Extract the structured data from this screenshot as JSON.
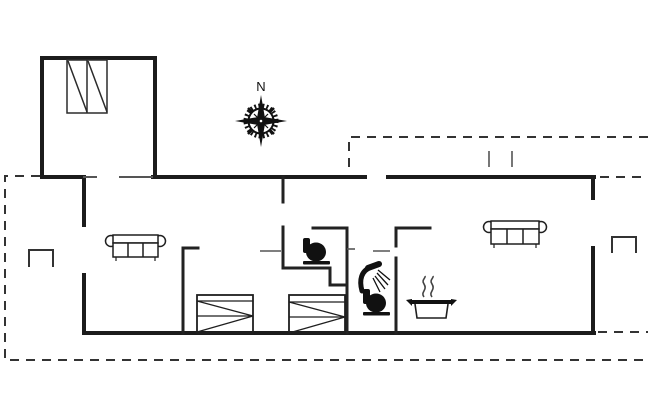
{
  "canvas": {
    "width": 650,
    "height": 420,
    "background": "#ffffff"
  },
  "colors": {
    "exterior_wall": "#1c1c1c",
    "interior_wall": "#222222",
    "furniture_line": "#1f1f1f",
    "furniture_fill": "#111111",
    "dashed_outline": "#333333",
    "thin_marks": "#555555"
  },
  "compass": {
    "north_label": "N"
  },
  "icons": [
    "compass-rose-icon",
    "wardrobe-icon",
    "sofa-icon",
    "bed-icon",
    "toilet-icon",
    "shower-icon",
    "cooking-pot-icon",
    "door-step-icon",
    "terrace-gate-marks"
  ],
  "furniture_counts": {
    "sofas": 2,
    "beds": 2,
    "toilets": 2,
    "showers": 1,
    "cooking_pots": 1
  }
}
